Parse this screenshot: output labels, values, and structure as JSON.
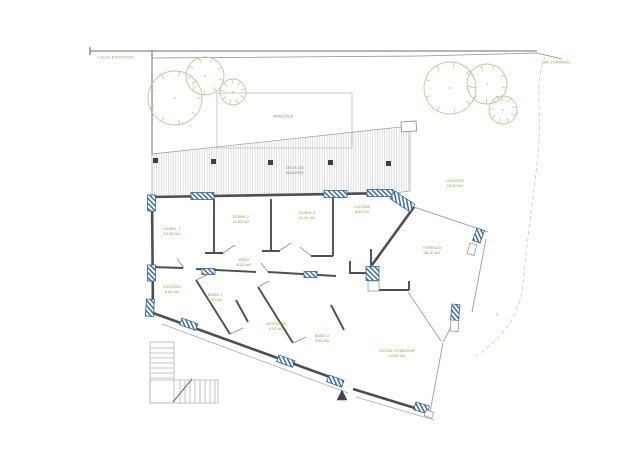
{
  "title": "Site / floor plan drawing",
  "colors": {
    "wall_gray": "#4f4f4f",
    "thin_gray": "#a6a6a6",
    "hatch_gray": "#cfcfcf",
    "glazing_blue": "#2e64a1",
    "vegetation_green": "#b3cf96",
    "label_green": "#76b041",
    "label_gray": "#8a8a8a"
  },
  "site": {
    "street_label": "CALLE EXISTENTE",
    "boundary_label": "LIM. TERRENO",
    "contour_mark": "1"
  },
  "outdoor": {
    "pergola_label": "PERGOLA",
    "deck_line1": "DECK DE",
    "deck_line2": "MADERA"
  },
  "rooms": [
    {
      "name": "GALERIA",
      "area": "28.40 m2"
    },
    {
      "name": "DORM. 1",
      "area": "12.50 m2"
    },
    {
      "name": "DORM. 2",
      "area": "11.80 m2"
    },
    {
      "name": "DORM. 3",
      "area": "11.20 m2"
    },
    {
      "name": "COCINA",
      "area": "8.60 m2"
    },
    {
      "name": "PASO",
      "area": "6.40 m2"
    },
    {
      "name": "TERRAZA",
      "area": "46.20 m2"
    },
    {
      "name": "ESTUDIO",
      "area": "9.80 m2"
    },
    {
      "name": "BAÑO 1",
      "area": "3.40 m2"
    },
    {
      "name": "VESTIDOR",
      "area": "4.20 m2"
    },
    {
      "name": "BAÑO 2",
      "area": "3.60 m2"
    },
    {
      "name": "ESTAR COMEDOR",
      "area": "34.50 m2"
    }
  ]
}
